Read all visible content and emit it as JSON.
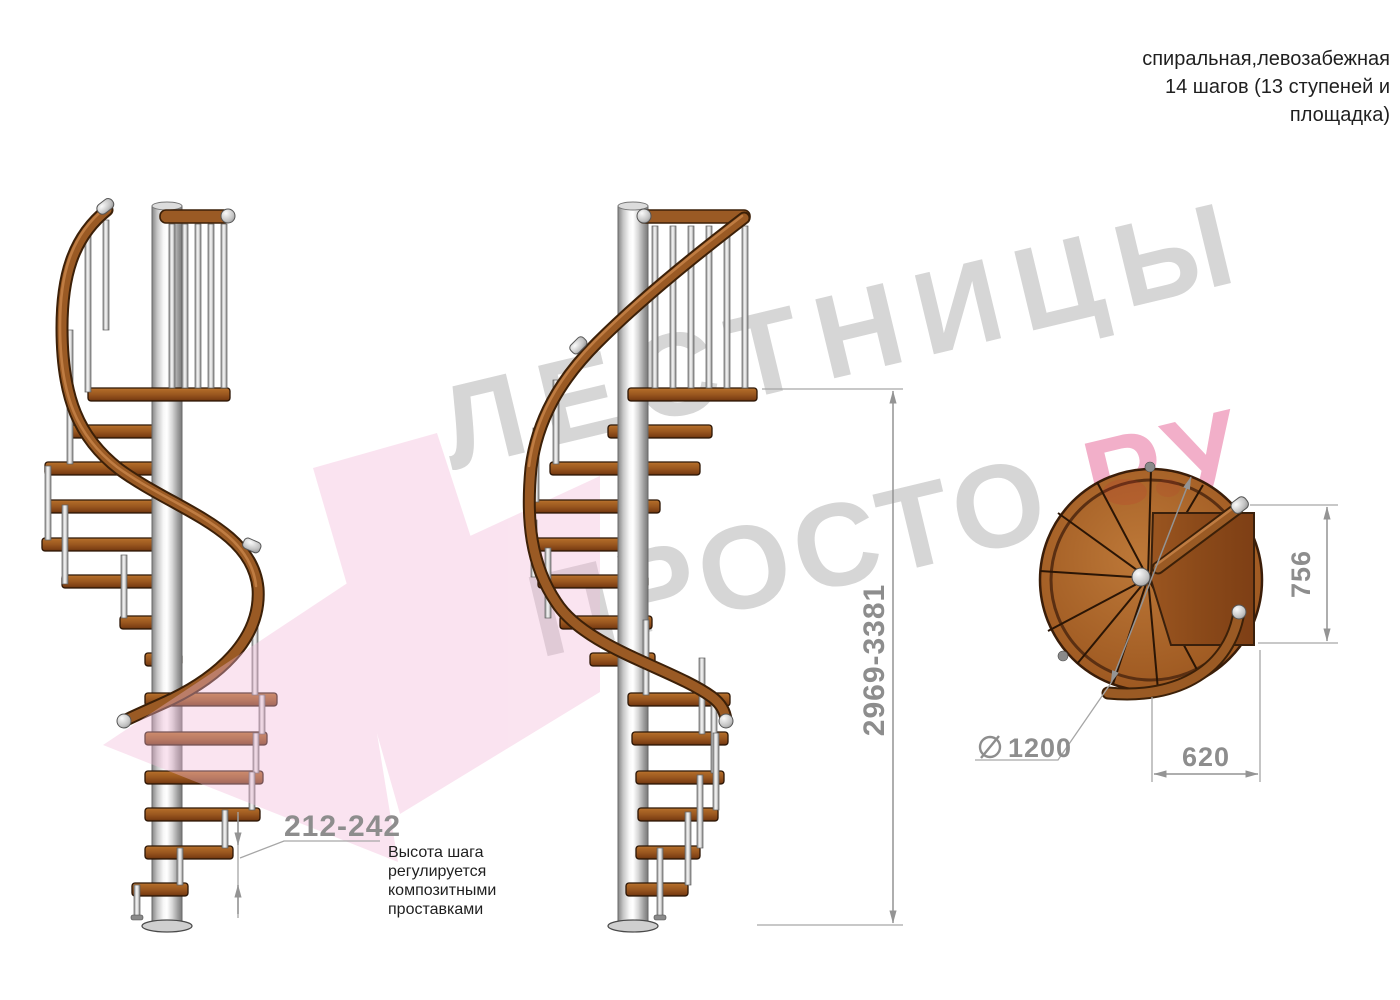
{
  "note_top_right": {
    "lines": [
      "спиральная,левозабежная",
      "14 шагов (13 ступеней и",
      "площадка)"
    ]
  },
  "dimensions": {
    "step_height": {
      "value": "212-242",
      "meaning": "регулируемая высота шага, мм"
    },
    "total_height": {
      "value": "2969-3381",
      "meaning": "общая высота лестницы, мм"
    },
    "diameter": {
      "value": "1200",
      "symbol": "⌀",
      "meaning": "диаметр лестницы, мм"
    },
    "landing_width": {
      "value": "620",
      "meaning": "ширина площадки от оси, мм"
    },
    "landing_depth": {
      "value": "756",
      "meaning": "глубина площадки, мм"
    }
  },
  "annotation_step_height": {
    "lines": [
      "Высота шага",
      "регулируется",
      "композитными",
      "проставками"
    ]
  },
  "watermark": {
    "line1": "ЛЕСТНИЦЫ",
    "line2_gray": "ПРОСТО",
    "dot": ".",
    "line2_pink": "РУ"
  },
  "colors": {
    "dimension_gray": "#8d8d8d",
    "text_black": "#1f1f1f",
    "watermark_gray": "#d6d6d6",
    "watermark_pink": "#f2afc9",
    "watermark_red": "#e04747",
    "watermark_arrow_pink": "#f3b8d8",
    "wood_brown": "#9a571f",
    "rail_brown": "#9a5a24",
    "metal_light": "#f5f5f5",
    "metal_dark": "#8c8c8c"
  },
  "views": {
    "side_view_1": "вид сбоку 1",
    "side_view_2": "вид сбоку 2",
    "top_view": "вид сверху (план)"
  }
}
